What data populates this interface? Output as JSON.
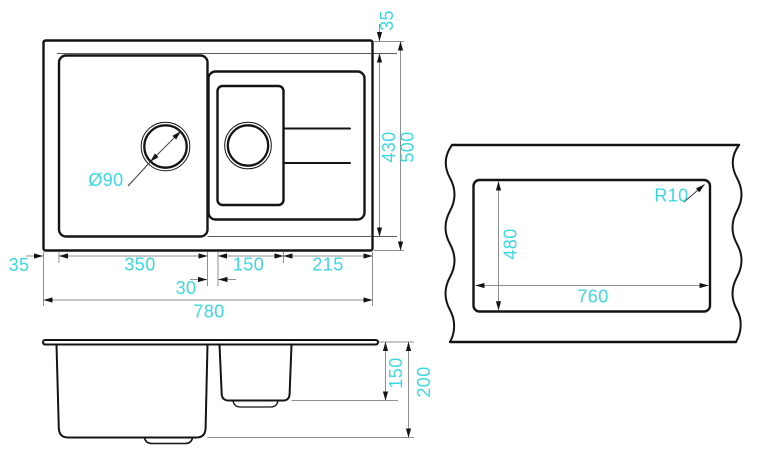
{
  "drawing_title": "sink-technical-drawing",
  "colors": {
    "accent": "#3CD7E2",
    "line": "#141414",
    "thin_line": "#8f8f8f"
  },
  "dims": {
    "top_view": {
      "rim_left": "35",
      "main_bowl_width": "350",
      "divider_width": "30",
      "small_bowl_width": "150",
      "drainer_width": "215",
      "total_width": "780",
      "rim_top": "35",
      "inner_depth": "430",
      "total_depth": "500",
      "drain_diameter": "Ø90"
    },
    "front_view": {
      "small_bowl_depth": "150",
      "main_bowl_depth": "200"
    },
    "cutout_view": {
      "cutout_height": "480",
      "cutout_width": "760",
      "corner_radius": "R10"
    }
  }
}
